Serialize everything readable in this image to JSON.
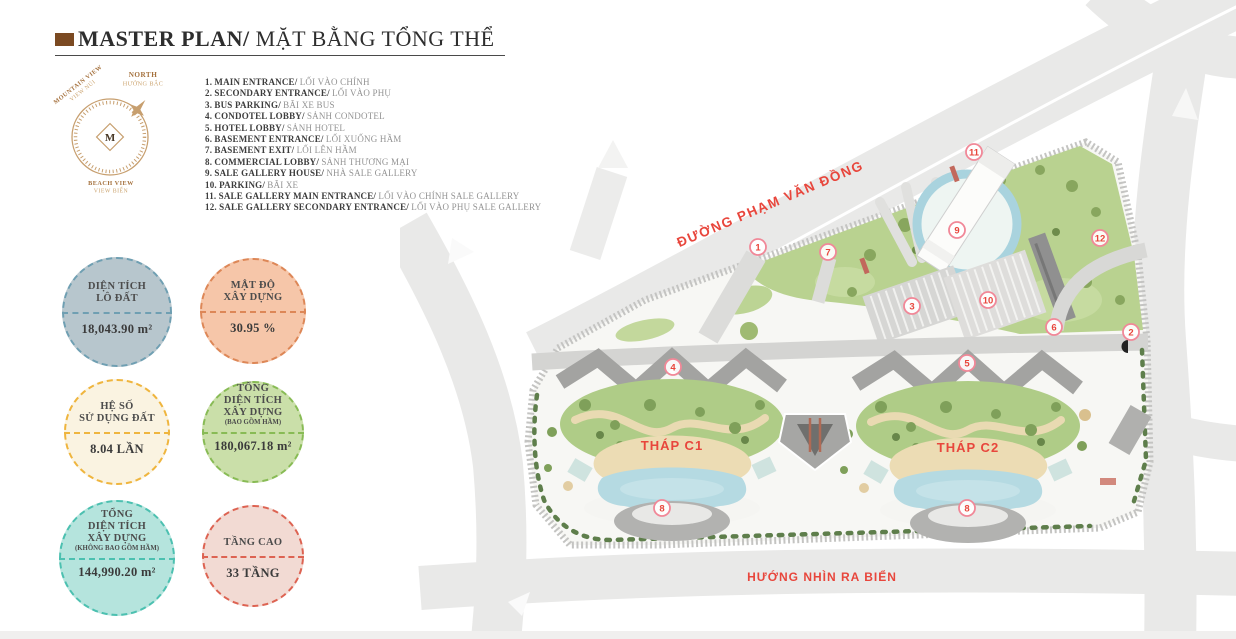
{
  "header": {
    "title_en": "MASTER PLAN/",
    "title_vi": " MẶT BẰNG TỔNG THỂ"
  },
  "compass": {
    "monogram": "M",
    "north_en": "NORTH",
    "north_vi": "HƯỚNG BẮC",
    "mountain_en": "MOUNTAIN VIEW",
    "mountain_vi": "VIEW NÚI",
    "beach_en": "BEACH VIEW",
    "beach_vi": "VIEW BIỂN"
  },
  "legend": {
    "items": [
      {
        "num": "1.",
        "en": "MAIN ENTRANCE/",
        "vi": "LỐI VÀO CHÍNH"
      },
      {
        "num": "2.",
        "en": "SECONDARY ENTRANCE/",
        "vi": "LỐI VÀO PHỤ"
      },
      {
        "num": "3.",
        "en": "BUS PARKING/",
        "vi": "BÃI XE BUS"
      },
      {
        "num": "4.",
        "en": "CONDOTEL LOBBY/",
        "vi": "SẢNH CONDOTEL"
      },
      {
        "num": "5.",
        "en": "HOTEL LOBBY/",
        "vi": "SẢNH HOTEL"
      },
      {
        "num": "6.",
        "en": "BASEMENT ENTRANCE/",
        "vi": "LỐI XUỐNG HẦM"
      },
      {
        "num": "7.",
        "en": "BASEMENT EXIT/",
        "vi": "LỐI LÊN HẦM"
      },
      {
        "num": "8.",
        "en": "COMMERCIAL LOBBY/",
        "vi": "SẢNH THƯƠNG MẠI"
      },
      {
        "num": "9.",
        "en": "SALE GALLERY HOUSE/",
        "vi": "NHÀ SALE GALLERY"
      },
      {
        "num": "10.",
        "en": "PARKING/",
        "vi": "BÃI XE"
      },
      {
        "num": "11.",
        "en": "SALE GALLERY MAIN ENTRANCE/",
        "vi": "LỐI VÀO CHÍNH SALE GALLERY"
      },
      {
        "num": "12.",
        "en": "SALE GALLERY SECONDARY ENTRANCE/",
        "vi": "LỐI VÀO PHỤ SALE GALLERY"
      }
    ]
  },
  "badges": [
    {
      "line1": "DIỆN TÍCH",
      "line2": "LÔ ĐẤT",
      "value": "18,043.90 m²",
      "fill": "#b7c6cd",
      "border": "#6f9fb2"
    },
    {
      "line1": "MẬT ĐỘ",
      "line2": "XÂY DỰNG",
      "value": "30.95 %",
      "fill": "#f6c6a9",
      "border": "#dd8757"
    },
    {
      "line1": "HỆ SỐ",
      "line2": "SỬ DỤNG ĐẤT",
      "value": "8.04 LẦN",
      "fill": "#faf3e1",
      "border": "#efb53e"
    },
    {
      "line1": "TỔNG",
      "line2": "DIỆN TÍCH",
      "line3": "XÂY DỰNG",
      "sub": "(BAO GỒM HẦM)",
      "value": "180,067.18 m²",
      "fill": "#cadfa9",
      "border": "#88bb55"
    },
    {
      "line1": "TỔNG",
      "line2": "DIỆN TÍCH",
      "line3": "XÂY DỰNG",
      "sub": "(KHÔNG BAO GỒM HẦM)",
      "value": "144,990.20 m²",
      "fill": "#b5e4dd",
      "border": "#4cc0b0"
    },
    {
      "line1": "TẦNG CAO",
      "value": "33 TẦNG",
      "fill": "#f2dad3",
      "border": "#dd6352"
    }
  ],
  "plan": {
    "street_label": "ĐƯỜNG PHẠM VĂN ĐỒNG",
    "sea_label": "HƯỚNG NHÌN RA BIỂN",
    "tower1": "THÁP C1",
    "tower2": "THÁP C2",
    "accent_red": "#e8463c",
    "markers": [
      {
        "num": "1"
      },
      {
        "num": "7"
      },
      {
        "num": "11"
      },
      {
        "num": "9"
      },
      {
        "num": "12"
      },
      {
        "num": "3"
      },
      {
        "num": "10"
      },
      {
        "num": "6"
      },
      {
        "num": "2"
      },
      {
        "num": "4"
      },
      {
        "num": "5"
      },
      {
        "num": "8"
      },
      {
        "num": "8"
      }
    ]
  }
}
